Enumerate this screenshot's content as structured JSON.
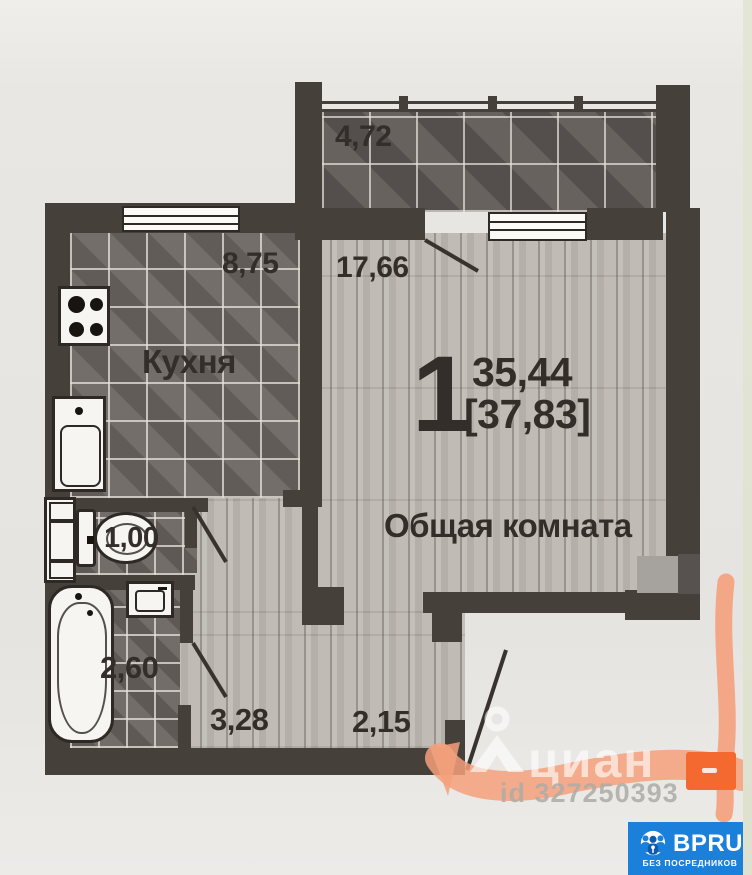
{
  "plan": {
    "summary": {
      "rooms_count": "1",
      "living_area": "35,44",
      "total_area": "[37,83]"
    },
    "rooms": {
      "balcony": {
        "area": "4,72"
      },
      "kitchen": {
        "name": "Кухня",
        "area": "8,75"
      },
      "living": {
        "name": "Общая комната",
        "area": "17,66"
      },
      "wc": {
        "area": "1,00"
      },
      "bath": {
        "area": "2,60"
      },
      "hall": {
        "area": "3,28"
      },
      "corridor": {
        "area": "2,15"
      }
    }
  },
  "watermark": {
    "brand": "циан",
    "listing_id": "id 327250393"
  },
  "badge": {
    "brand": "BPRU",
    "tagline": "БЕЗ ПОСРЕДНИКОВ"
  },
  "colors": {
    "wall": "#46403a",
    "marker": "#f4a07c",
    "marker_solid": "#f3692f",
    "badge_bg": "#1b80da"
  }
}
